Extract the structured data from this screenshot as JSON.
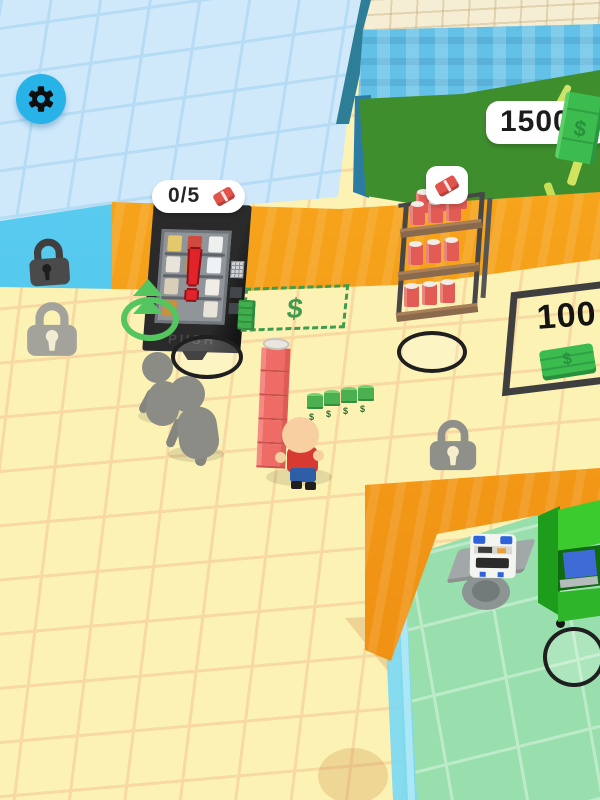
{
  "hud": {
    "settings_button": {
      "icon": "gear-icon"
    },
    "stock_badge": {
      "count": "0/5",
      "icon": "soda-can-icon"
    },
    "cash_badge": {
      "amount": "1500",
      "icon": "money-bill-icon"
    }
  },
  "world": {
    "vending_machine": {
      "alert": "!",
      "push_label": "PUSH"
    },
    "sell_zone": {
      "symbol": "$"
    },
    "buy_zone": {
      "price": "100",
      "icon": "money-bill-icon"
    },
    "shelf_badge": {
      "icon": "soda-can-icon"
    },
    "currency_symbol": "$"
  },
  "colors": {
    "settings_blue": "#27b2e8",
    "alert_red": "#e2232b",
    "money_green": "#3cbb4e",
    "zone_green": "#3f9b4f",
    "floor_yellow": "#fcf2b4",
    "floor_blue_tiles": "#cfe9fb",
    "floor_mint": "#99dfad",
    "wall_orange": "#f5a01b",
    "money_room_green": "#3e8e2d"
  }
}
